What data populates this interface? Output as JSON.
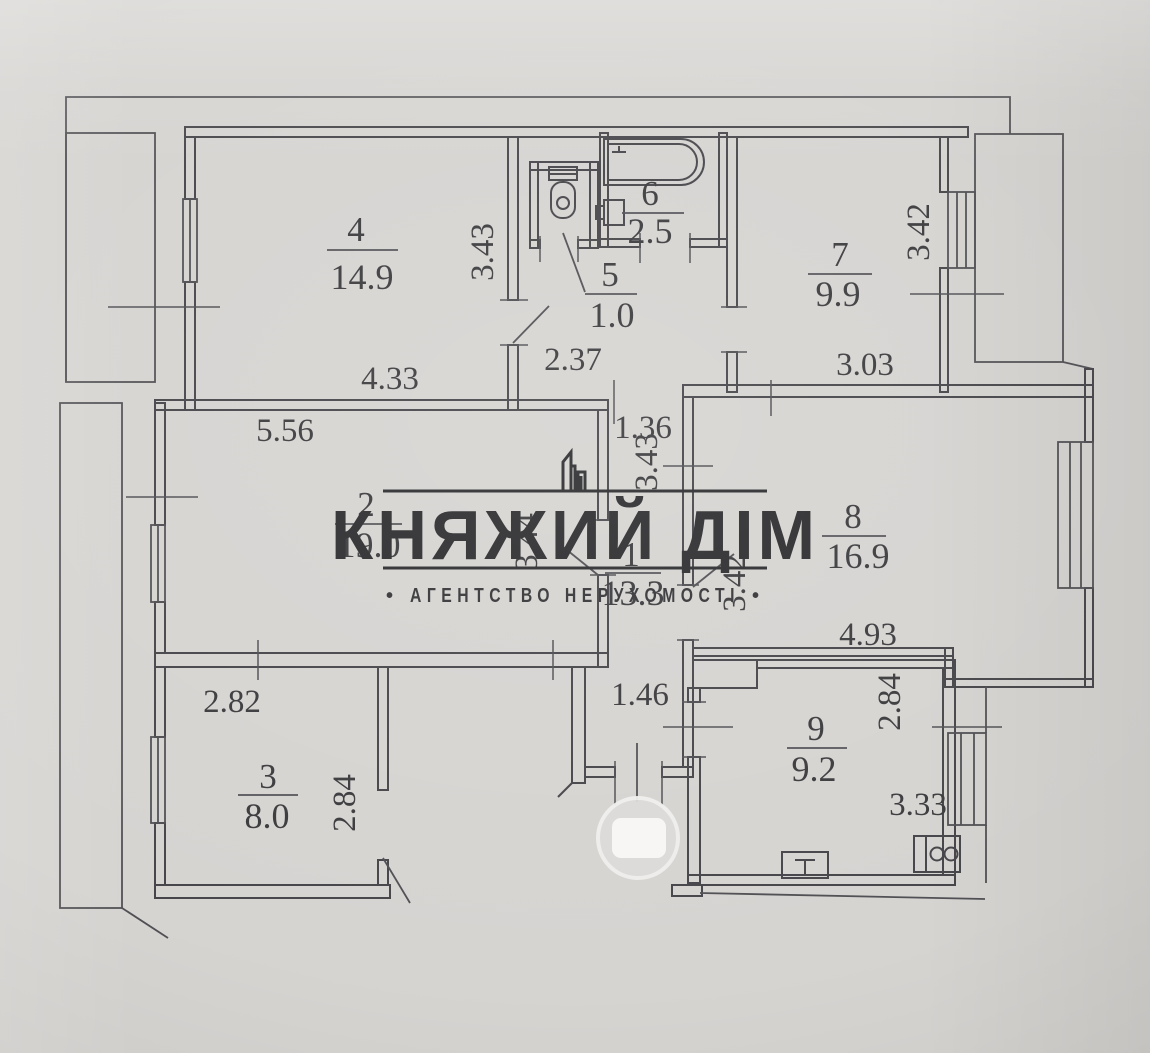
{
  "watermark": {
    "brand": "КНЯЖИЙ ДІМ",
    "tagline": "АГЕНТСТВО НЕРУХОМОСТІ",
    "bullet": "•"
  },
  "plan": {
    "rooms": [
      {
        "number": "1",
        "area": "13.3"
      },
      {
        "number": "2",
        "area": "19.0"
      },
      {
        "number": "3",
        "area": "8.0"
      },
      {
        "number": "4",
        "area": "14.9"
      },
      {
        "number": "5",
        "area": "1.0"
      },
      {
        "number": "6",
        "area": "2.5"
      },
      {
        "number": "7",
        "area": "9.9"
      },
      {
        "number": "8",
        "area": "16.9"
      },
      {
        "number": "9",
        "area": "9.2"
      }
    ],
    "dimensions": {
      "room4_height": "3.43",
      "room4_width": "4.33",
      "hall_width": "2.37",
      "room7_height": "3.42",
      "room7_width": "3.03",
      "room2_width": "5.56",
      "room2_height": "3.44",
      "corridor_width": "1.36",
      "corridor_height": "3.43",
      "room8_left_height": "3.42",
      "room8_width": "4.93",
      "room3_width": "2.82",
      "room3_height": "2.84",
      "hall_lower_width": "1.46",
      "room9_height": "2.84",
      "room9_width": "3.33"
    },
    "colors": {
      "ink": "#46464a",
      "paper": "#d6d4d1"
    }
  }
}
